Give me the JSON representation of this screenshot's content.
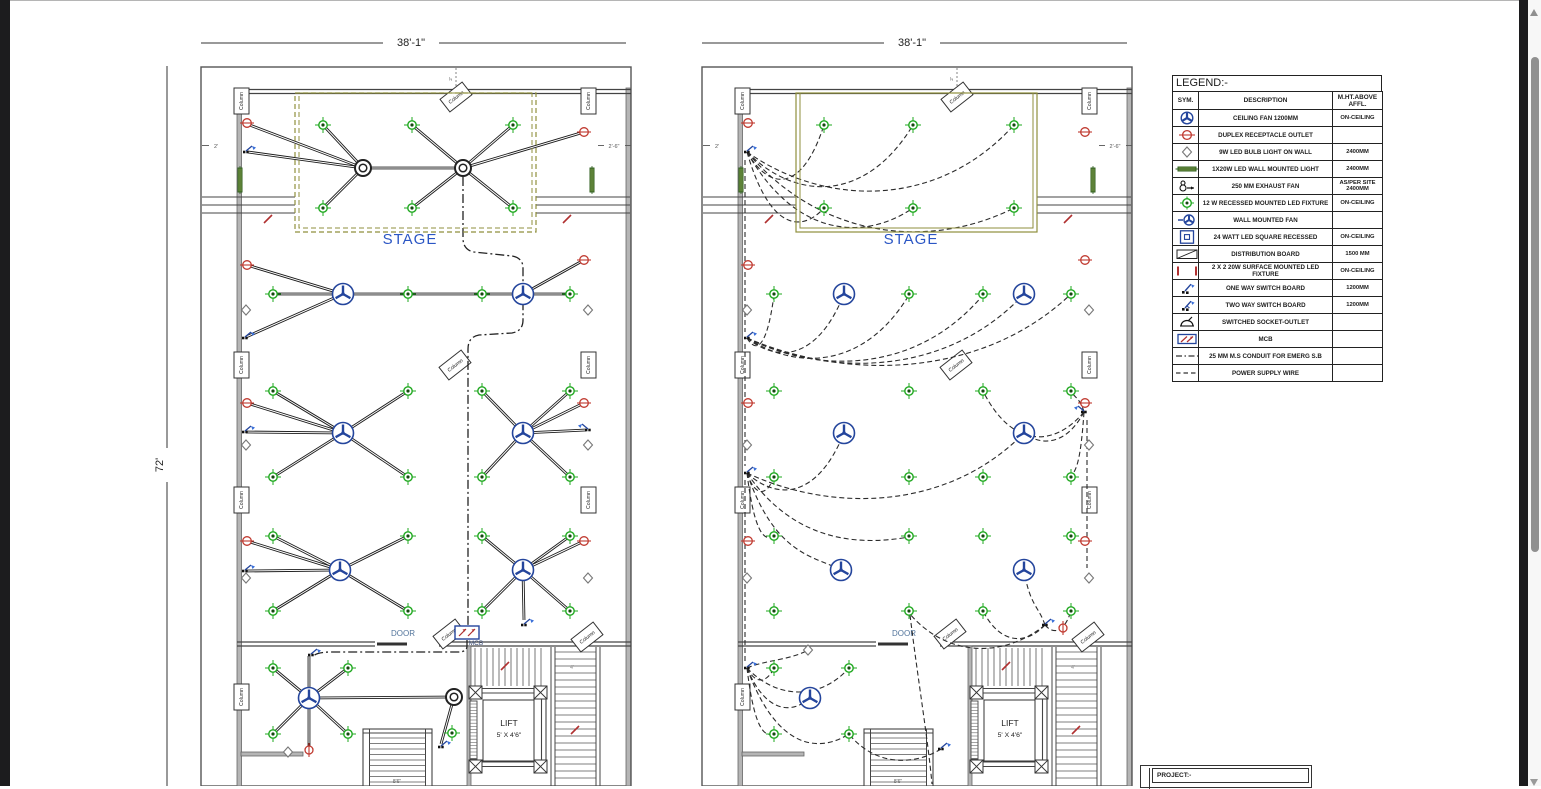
{
  "dimensions": {
    "plan_width": "38'-1\"",
    "plan_height": "72'",
    "wall_offset_left": "2'",
    "wall_offset_right": "2'-6\"",
    "stair_run": "8'6\"",
    "stair_width": "4'"
  },
  "labels": {
    "stage": "STAGE",
    "door": "DOOR",
    "mcb": "MCB",
    "lift": "LIFT",
    "lift_size": "5' X 4'6\"",
    "column": "Column",
    "project": "PROJECT:-"
  },
  "legend": {
    "title": "LEGEND:-",
    "headers": {
      "sym": "SYM.",
      "description": "DESCRIPTION",
      "height": "M.HT.ABOVE AFFL."
    },
    "rows": [
      {
        "sym": "ceiling-fan",
        "description": "CEILING FAN 1200MM",
        "height": "ON-CEILING"
      },
      {
        "sym": "duplex-outlet",
        "description": "DUPLEX RECEPTACLE OUTLET",
        "height": ""
      },
      {
        "sym": "bulb-wall-light",
        "description": "9W LED BULB LIGHT ON WALL",
        "height": "2400MM"
      },
      {
        "sym": "led-wall-light",
        "description": "1X20W LED WALL MOUNTED LIGHT",
        "height": "2400MM"
      },
      {
        "sym": "exhaust-fan",
        "description": "250 MM EXHAUST FAN",
        "height": "AS/PER SITE 2400MM"
      },
      {
        "sym": "recessed-led",
        "description": "12 W RECESSED MOUNTED LED FIXTURE",
        "height": "ON-CEILING"
      },
      {
        "sym": "wall-fan",
        "description": "WALL MOUNTED FAN",
        "height": ""
      },
      {
        "sym": "square-recessed",
        "description": "24 WATT LED SQUARE RECESSED",
        "height": "ON-CEILING"
      },
      {
        "sym": "distribution-board",
        "description": "DISTRIBUTION BOARD",
        "height": "1500 MM"
      },
      {
        "sym": "surface-led",
        "description": "2 X 2 20W SURFACE MOUNTED LED FIXTURE",
        "height": "ON-CEILING"
      },
      {
        "sym": "one-way-switch",
        "description": "ONE WAY SWITCH BOARD",
        "height": "1200MM"
      },
      {
        "sym": "two-way-switch",
        "description": "TWO WAY SWITCH BOARD",
        "height": "1200MM"
      },
      {
        "sym": "switched-socket",
        "description": "SWITCHED SOCKET-OUTLET",
        "height": ""
      },
      {
        "sym": "mcb",
        "description": "MCB",
        "height": ""
      },
      {
        "sym": "conduit-line",
        "description": "25 MM M.S CONDUIT FOR EMERG S.B",
        "height": ""
      },
      {
        "sym": "power-wire",
        "description": "POWER SUPPLY WIRE",
        "height": ""
      }
    ]
  },
  "colors": {
    "fixture_green": "#1fa81f",
    "fixture_green_dark": "#14490f",
    "outlet_red": "#c03a30",
    "device_navy": "#24459c",
    "stage_blue": "#2b56c4",
    "stage_border_olive": "#8f8f3c",
    "wall_gray": "#b5b5b5",
    "wall_edge": "#666666",
    "tick_red": "#b03030",
    "line_dark": "#1b1b1b",
    "dim_gray": "#555555",
    "door_text": "#53759c",
    "mcb_text": "#3c4f7a"
  }
}
